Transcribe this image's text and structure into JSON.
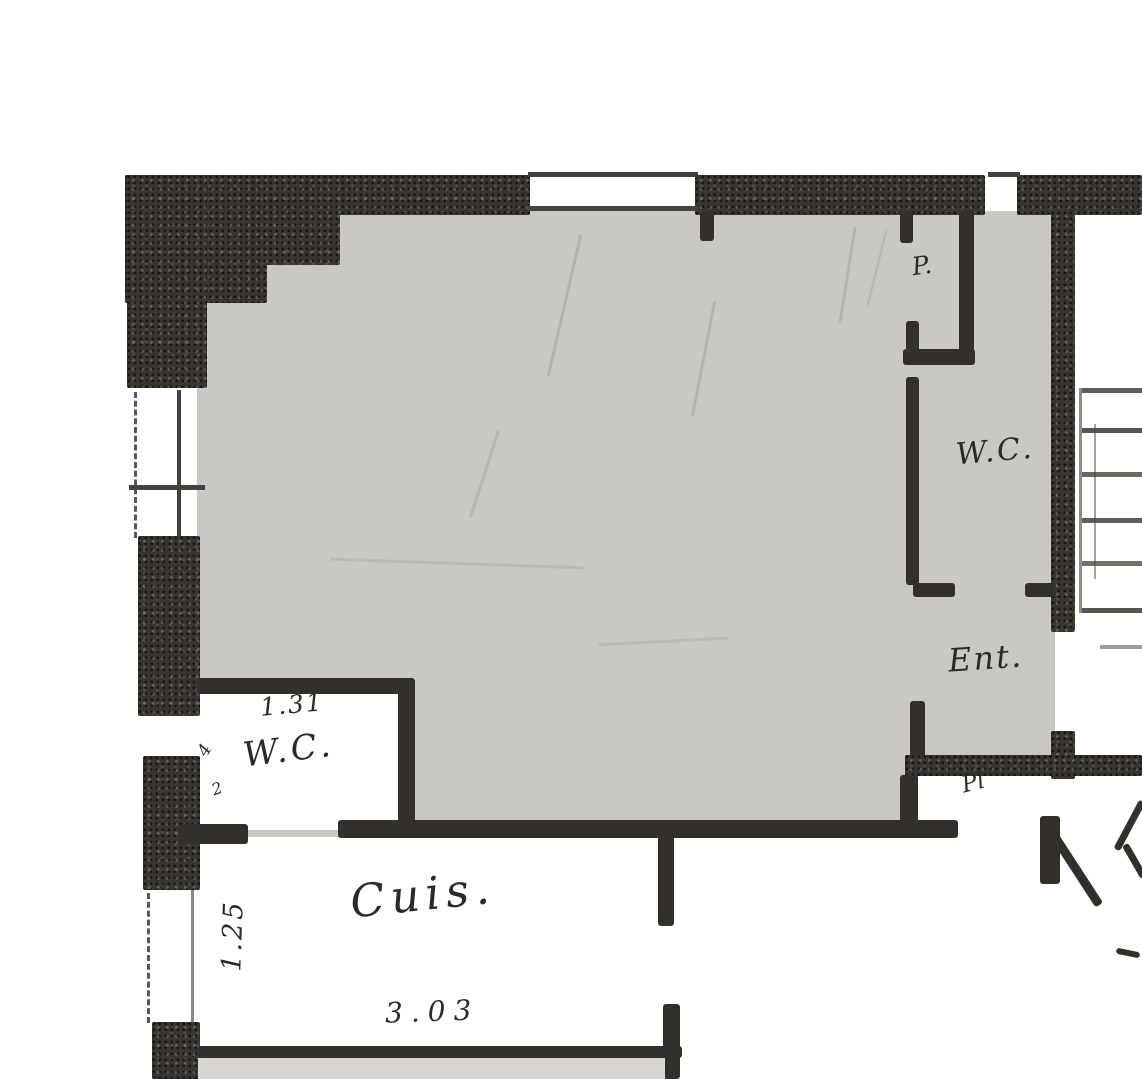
{
  "document": {
    "type": "floor-plan",
    "style": "hand-drawn scanned blueprint, partial view"
  },
  "labels": {
    "closet_p": "P.",
    "wc_right": "W.C.",
    "entry": "Ent.",
    "closet_pl": "Pl",
    "wc_left": "W.C.",
    "kitchen": "Cuis.",
    "marks": [
      "4",
      "2"
    ]
  },
  "dimensions": {
    "wc_left_width": "1.31",
    "kitchen_width": "3.03",
    "kitchen_height": "1.25"
  },
  "colors": {
    "paper": "#ffffff",
    "room_shading": "#c9c8c4",
    "wall_ink": "#38352f",
    "label_ink": "#2b2a28",
    "pencil_marks": "#aeaca7",
    "floor_strip": "#d6d5d1"
  },
  "features": {
    "stair_treads_visible": 7,
    "stairs_position": "right edge",
    "door_swing_count": 1,
    "shaded_rooms": [
      "main room",
      "closet P.",
      "W.C. right",
      "Ent."
    ],
    "unshaded_rooms": [
      "W.C. left",
      "Cuis.",
      "Pl"
    ]
  }
}
